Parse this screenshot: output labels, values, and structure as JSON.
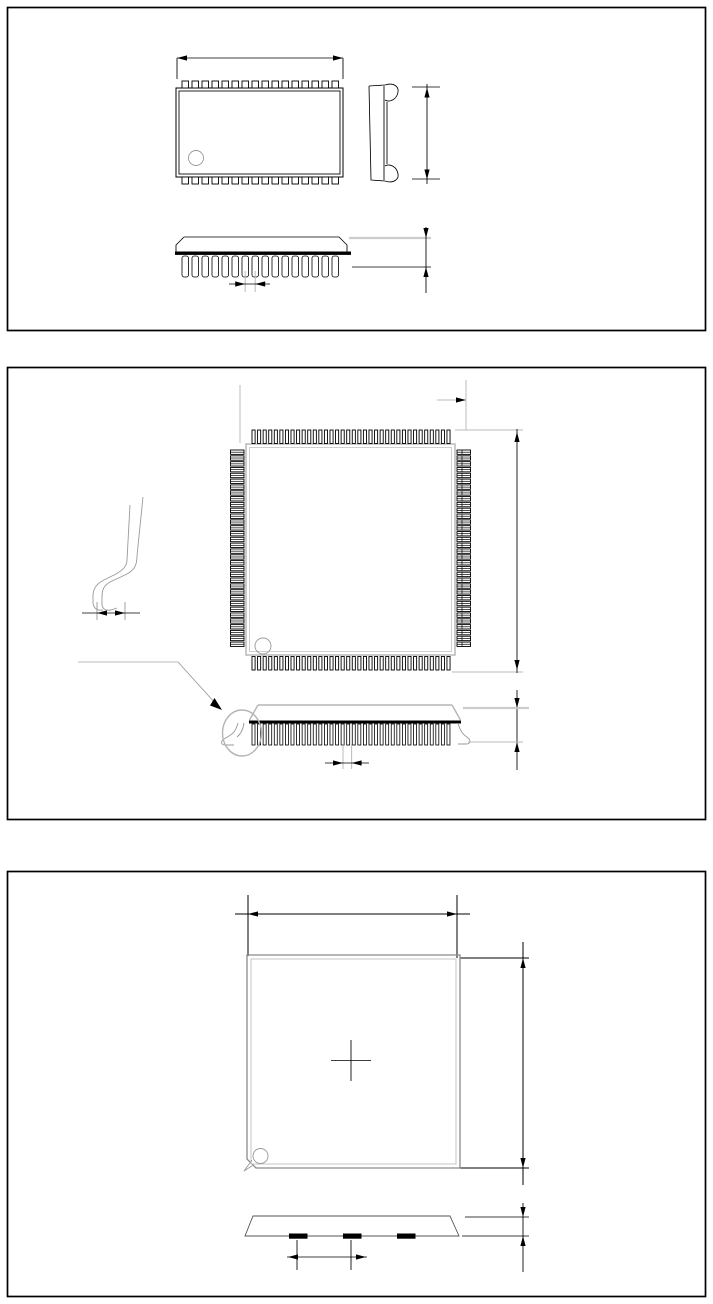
{
  "canvas": {
    "width": 713,
    "height": 1304,
    "background": "#ffffff",
    "frame_color": "#000000"
  },
  "colors": {
    "ink": "#000000",
    "light_gray": "#bbbbbb",
    "mid_gray": "#999999",
    "body_gray": "#b5b5b5"
  },
  "sections": {
    "sop": {
      "top_view": {
        "pins_top": 16,
        "pins_bottom": 16,
        "pin1_marker": "circle"
      },
      "side_view": {
        "lead_style": "j-lead"
      },
      "front_view": {
        "leads": 16
      },
      "dimensions": [
        "body-width",
        "body-height",
        "seating-height",
        "lead-pitch"
      ]
    },
    "qfp": {
      "top_view": {
        "pins_top": 36,
        "pins_bottom": 36,
        "pins_left": 34,
        "pins_right": 34,
        "pin1_marker": "circle"
      },
      "side_view": {
        "leads": 36,
        "detail_marker": "detail-circle-with-leader-arrow"
      },
      "lead_detail": {
        "lead_style": "gull-wing"
      },
      "dimensions": [
        "pin-offset",
        "body-span",
        "stand-off-height",
        "lead-pitch",
        "foot-length"
      ]
    },
    "die": {
      "top_view": {
        "center_marker": "cross",
        "pin1_marker": "circle",
        "corner": "chamfered"
      },
      "side_view": {
        "pads": 3
      },
      "dimensions": [
        "body-width",
        "body-height",
        "thickness",
        "pad-pitch"
      ]
    }
  }
}
